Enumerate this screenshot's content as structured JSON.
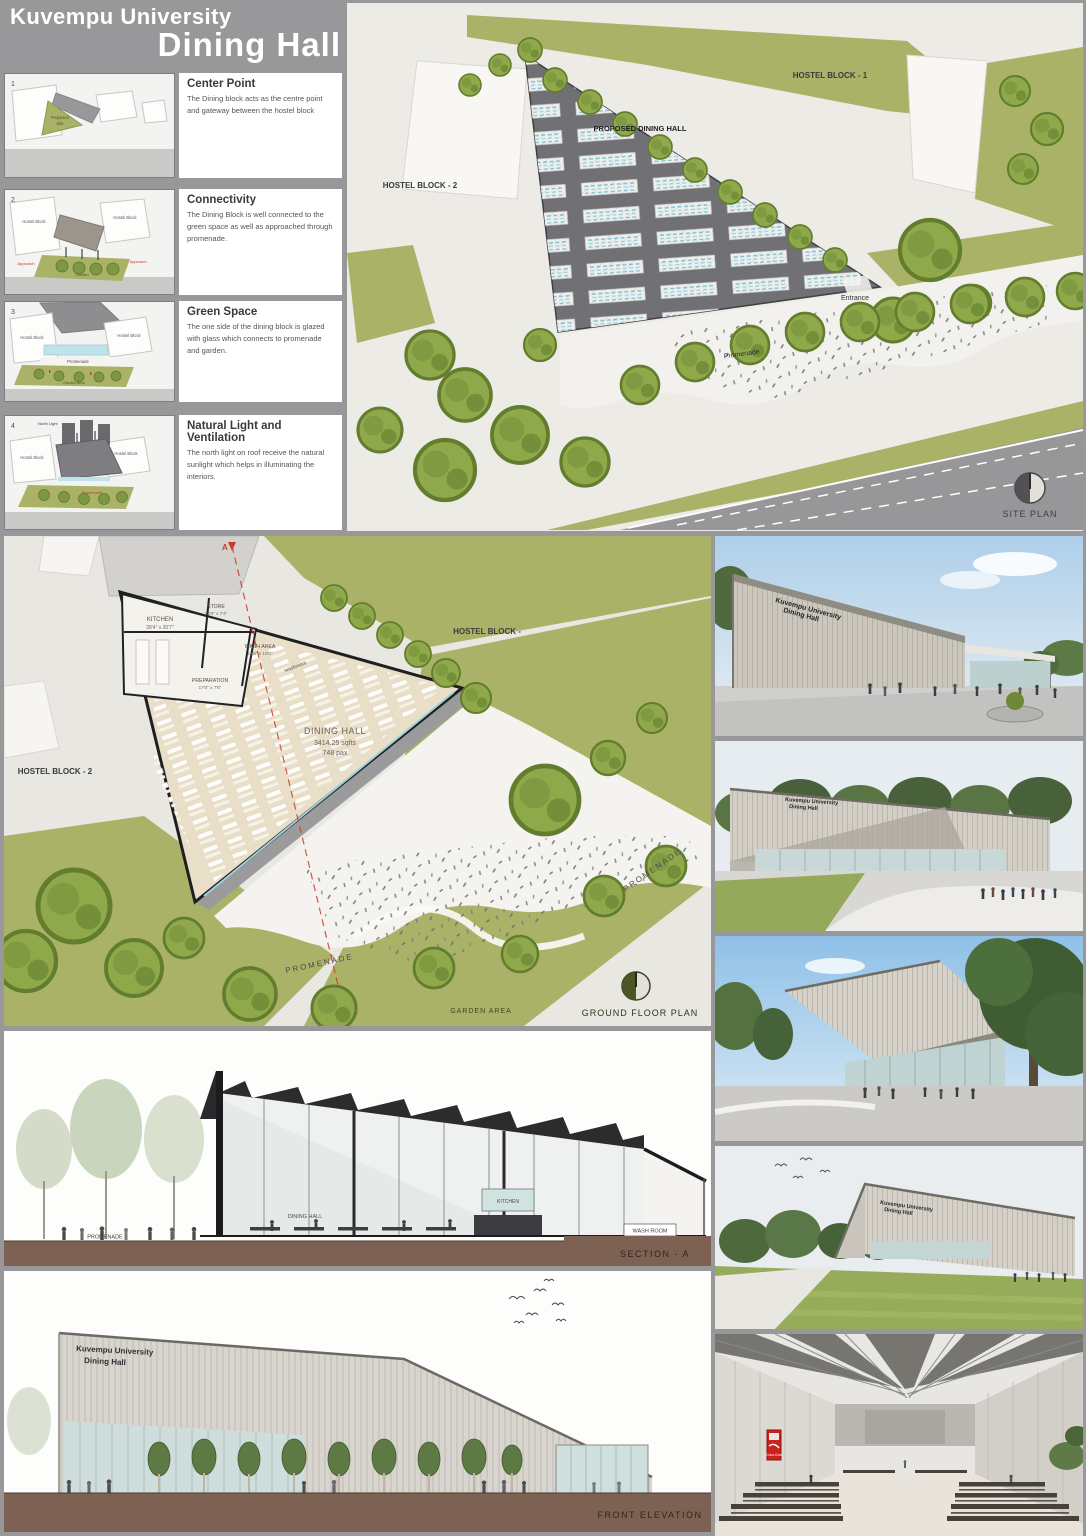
{
  "colors": {
    "board_bg": "#98989a",
    "banner_text": "#ffffff",
    "olive": "#a9b266",
    "tree_green": "#8fa94a",
    "roof_gray": "#717175",
    "floor_beige": "#e9dfc8",
    "paving": "#edebe6",
    "ground_brown": "#7d6254",
    "sky_blue": "#9ec7e8",
    "accent_red": "#cc3a2a",
    "glass_blue": "#bfe3ea"
  },
  "banner": {
    "university": "Kuvempu University",
    "project": "Dining Hall"
  },
  "concepts": [
    {
      "num": "1",
      "heading": "Center Point",
      "body": "The Dining block acts as the centre point and gateway between the hostel block",
      "labels": {
        "site1": "Proposed",
        "site2": "Site"
      }
    },
    {
      "num": "2",
      "heading": "Connectivity",
      "body": "The Dining Block is well connected to the green space as well as approached through promenade.",
      "labels": {
        "left": "Hostel Block",
        "right": "Hostel Block",
        "approach_left": "Approach",
        "approach_right": "Approach",
        "garden": "Garden"
      }
    },
    {
      "num": "3",
      "heading": "Green Space",
      "body": "The one side of the dining block is glazed with glass which connects to promenade and garden.",
      "labels": {
        "left": "Hostel Block",
        "right": "Hostel Block",
        "promenade": "Promenade",
        "garden": "Garden Area"
      }
    },
    {
      "num": "4",
      "heading": "Natural Light and Ventilation",
      "body": "The north light on roof receive the natural sunlight which helps in illuminating the interiors.",
      "labels": {
        "left": "Hostel Block",
        "right": "Hostel Block",
        "north": "North Light",
        "promenade": "Promenade"
      }
    }
  ],
  "site_plan": {
    "hostel1": "HOSTEL BLOCK - 1",
    "hostel2": "HOSTEL BLOCK - 2",
    "proposed": "PROPOSED DINING HALL",
    "entrance": "Entrance",
    "promenade": "Promenade",
    "caption": "SITE PLAN"
  },
  "floor_plan": {
    "dining_name": "DINING HALL",
    "dining_area": "3414.25 sqfts",
    "dining_pax": "748 pax",
    "kitchen": "KITCHEN",
    "kitchen_dim": "28'4\" x 20'7\"",
    "store": "STORE",
    "store_dim": "12'0\" x 7'4\"",
    "wash_area": "WASH AREA",
    "wash_area_dim": "13'6\" x 10'0\"",
    "preparation": "PREPARATION",
    "preparation_dim": "17'0\" x 7'6\"",
    "washroom": "washroom",
    "hostel1": "HOSTEL BLOCK -",
    "hostel2": "HOSTEL BLOCK - 2",
    "promenade_right": "PROMENADE",
    "promenade_bottom": "PROMENADE",
    "garden": "GARDEN AREA",
    "caption": "GROUND FLOOR PLAN",
    "section_marker": "A"
  },
  "section": {
    "promenade": "PROMENADE",
    "dining": "DINING HALL",
    "kitchen": "KITCHEN",
    "washroom": "WASH ROOM",
    "caption": "SECTION - A"
  },
  "elevation": {
    "sign1": "Kuvempu University",
    "sign2": "Dining Hall",
    "caption": "FRONT ELEVATION"
  },
  "renders": {
    "r1": {
      "sign1": "Kuvempu University",
      "sign2": "Dining Hall"
    },
    "r2": {
      "sign1": "Kuvempu University",
      "sign2": "Dining Hall"
    },
    "r4": {
      "sign1": "Kuvempu University",
      "sign2": "Dining Hall"
    },
    "r5": {
      "vending": "Coca-Cola"
    }
  }
}
